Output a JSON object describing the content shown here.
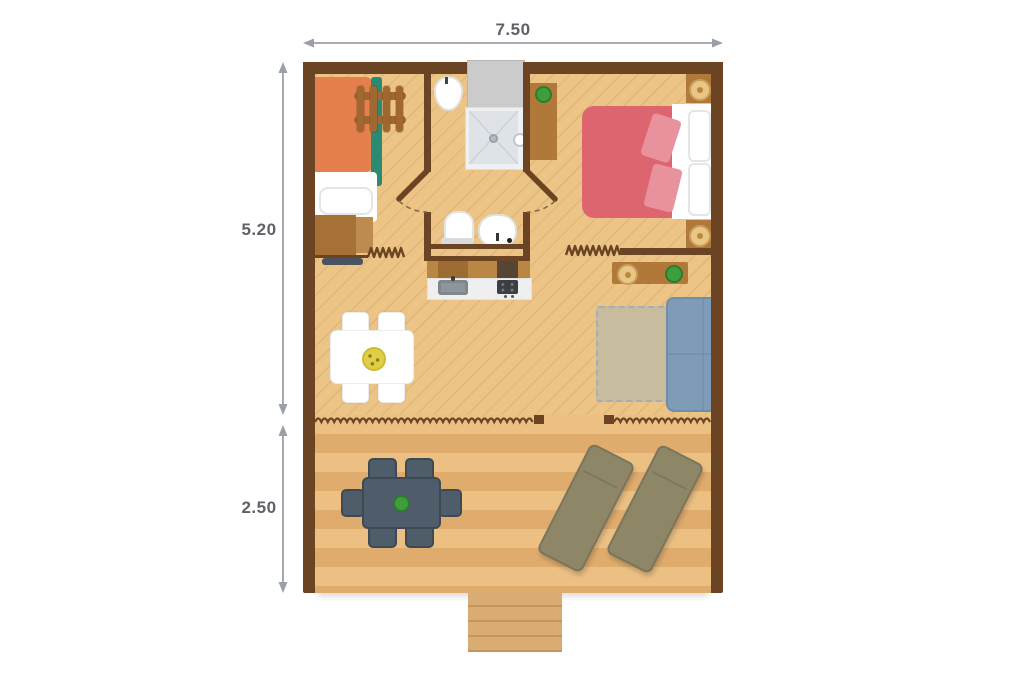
{
  "plan": {
    "dimensions": {
      "width": {
        "label": "7.50"
      },
      "interior_depth": {
        "label": "5.20"
      },
      "terrace_depth": {
        "label": "2.50"
      }
    },
    "colors": {
      "wall": "#6b4423",
      "floor": "#ecc486",
      "terrace_light": "#ecc083",
      "terrace_dark": "#e0ac6d",
      "wood": "#b0793a",
      "wood_dark": "#a06830",
      "bed_orange": "#e57f4e",
      "teal": "#2b8a72",
      "bed_red": "#dc6570",
      "pink": "#e7929c",
      "sofa": "#7e9cb8",
      "sofa_border": "#6f8ea9",
      "rug": "#c8bc9f",
      "slate": "#4e5d69",
      "slate_border": "#3d4a55",
      "olive": "#8d8767",
      "olive_border": "#7b755b",
      "shower": "#dfe3e8",
      "entrance": "#cbcbcb",
      "plant": "#3f9e3c",
      "plant_dark": "#2e7b2c",
      "lamp": "#e9c687",
      "lamp_ring": "#c99e58",
      "yellow": "#e0cf45",
      "steps": "#d9ac73",
      "steps_line": "#c2965e",
      "dim_text": "#5f6068",
      "dim_arrow": "#9aa0a6"
    },
    "items": [
      "bunk-bed",
      "bunk-ladder",
      "dresser",
      "bench",
      "entrance-mat",
      "bidet",
      "shower",
      "toilet",
      "washbasin",
      "kitchen-cabinets",
      "kitchen-counter",
      "kitchen-sink",
      "stove",
      "wardrobe",
      "double-bed",
      "nightstand",
      "table-lamp",
      "console-table",
      "potted-plant",
      "rug",
      "sofa",
      "dining-table",
      "dining-chair",
      "canvas-wall",
      "terrace",
      "terrace-table",
      "terrace-chair",
      "sun-lounger",
      "steps"
    ]
  }
}
